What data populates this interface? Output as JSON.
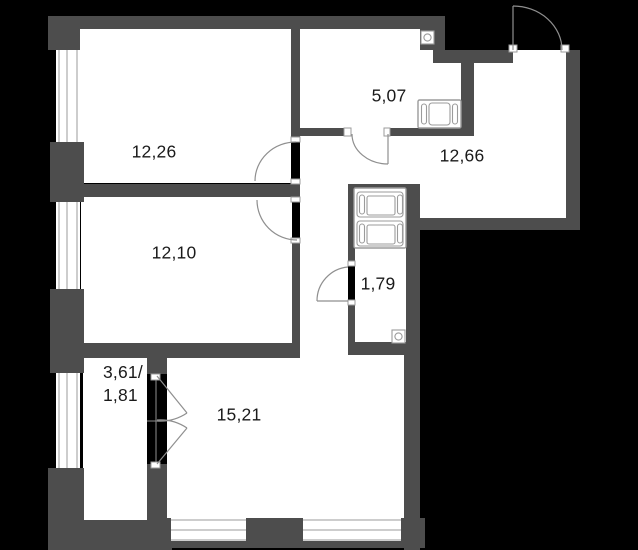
{
  "title": "apartment-floor-plan",
  "rooms": [
    {
      "id": "room-12-26",
      "area": "12,26"
    },
    {
      "id": "room-5-07",
      "area": "5,07"
    },
    {
      "id": "room-12-66",
      "area": "12,66"
    },
    {
      "id": "room-12-10",
      "area": "12,10"
    },
    {
      "id": "room-1-79",
      "area": "1,79"
    },
    {
      "id": "room-15-21",
      "area": "15,21"
    },
    {
      "id": "room-balcony",
      "area_line1": "3,61/",
      "area_line2": "1,81"
    }
  ],
  "fixtures": [
    {
      "icon": "washer-dryer-stack-icon"
    },
    {
      "icon": "bathtub-icon"
    },
    {
      "icon": "ventilation-grille-icon"
    },
    {
      "icon": "ventilation-grille-icon"
    }
  ],
  "doors": [
    {
      "name": "entrance-door"
    },
    {
      "name": "bathroom-door"
    },
    {
      "name": "room-12-26-door"
    },
    {
      "name": "room-12-10-door"
    },
    {
      "name": "wc-1-79-door"
    },
    {
      "name": "balcony-french-doors"
    }
  ],
  "colors": {
    "background": "#000000",
    "wall": "#4d4d4d",
    "floor": "#ffffff",
    "frame_line": "#9b9b9b",
    "door_arc": "#8f8f8f",
    "text": "#1a1a1a"
  }
}
